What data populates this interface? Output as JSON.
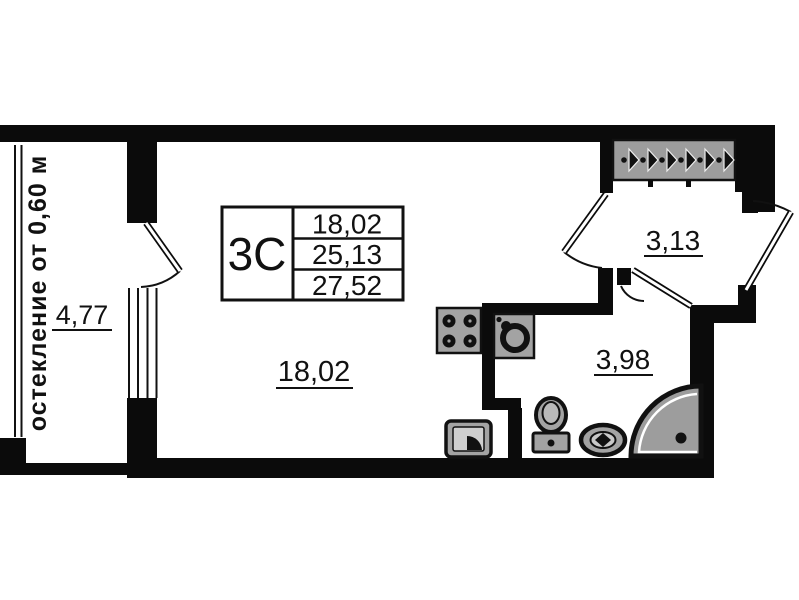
{
  "plan": {
    "title": "studio apartment floor plan",
    "stamp": {
      "unit_label": "3С",
      "rows": [
        "18,02",
        "25,13",
        "27,52"
      ]
    },
    "rooms": {
      "balcony": {
        "area": "4,77",
        "glazing_note": "остекление от 0,60 м"
      },
      "living": {
        "area": "18,02"
      },
      "hallway": {
        "area": "3,13"
      },
      "bathroom": {
        "area": "3,98"
      }
    },
    "icons": {
      "wardrobe": "hanger-row-icon",
      "kitchen": [
        "stove-icon",
        "kitchen-sink-icon"
      ],
      "bathroom": [
        "toilet-icon",
        "washbasin-icon",
        "shower-icon"
      ],
      "appliance": "washing-machine-icon"
    },
    "colors": {
      "wall": "#0b0b0b",
      "background": "#ffffff",
      "fixture_fill": "#a3a3a3",
      "wardrobe_fill": "#9d9d9d",
      "shower_fill": "#9d9d9d"
    }
  }
}
